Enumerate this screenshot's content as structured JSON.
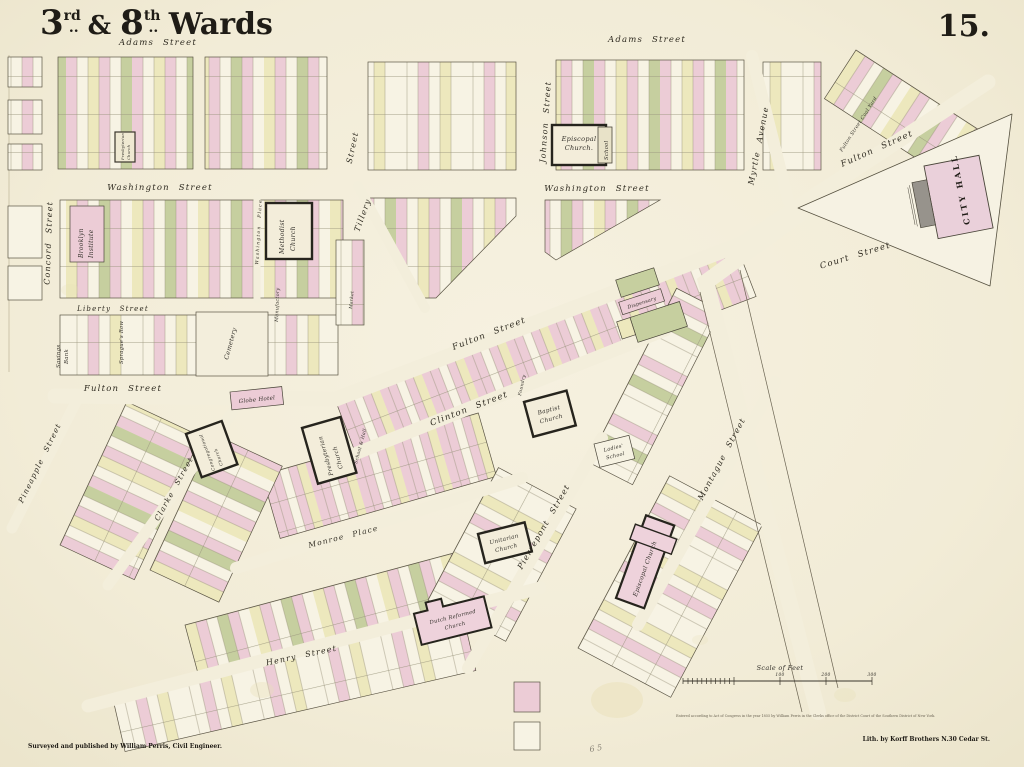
{
  "map": {
    "title": "3rd. & 8th. Wards",
    "title_parts": {
      "p1": "3",
      "p2": "rd",
      "p3": "..",
      "p4": " & ",
      "p5": "8",
      "p6": "th",
      "p7": "..",
      "p8": " Wards"
    },
    "plate_number": "15.",
    "pencil_note": "6 5"
  },
  "palette": {
    "paper": "#f3eedb",
    "block": "#f7f3e4",
    "pink": "#ecccd6",
    "yellow": "#ede8bd",
    "green": "#c6cf9f",
    "ink": "#3a362c",
    "church_fill": "#f3edda",
    "gray": "#97938c"
  },
  "streets": [
    {
      "name": "adams-street-west",
      "label": "Adams Street"
    },
    {
      "name": "adams-street-east",
      "label": "Adams Street"
    },
    {
      "name": "washington-street-west",
      "label": "Washington Street"
    },
    {
      "name": "washington-street-east",
      "label": "Washington Street"
    },
    {
      "name": "concord-street",
      "label": "Concord Street"
    },
    {
      "name": "johnson-street",
      "label": "Johnson Street"
    },
    {
      "name": "pearl-street-partial",
      "label": "Street"
    },
    {
      "name": "tillary-street",
      "label": "Tillery"
    },
    {
      "name": "washington-place",
      "label": "Washington Place"
    },
    {
      "name": "myrtle-avenue",
      "label": "Myrtle Avenue"
    },
    {
      "name": "fulton-street-northeast",
      "label": "Fulton Street"
    },
    {
      "name": "court-street",
      "label": "Court Street"
    },
    {
      "name": "liberty-street",
      "label": "Liberty Street"
    },
    {
      "name": "fulton-street-west",
      "label": "Fulton Street"
    },
    {
      "name": "fulton-street-center",
      "label": "Fulton Street"
    },
    {
      "name": "clinton-street",
      "label": "Clinton Street"
    },
    {
      "name": "pineapple-street",
      "label": "Pineapple Street"
    },
    {
      "name": "clarke-street",
      "label": "Clarke Street"
    },
    {
      "name": "monroe-place",
      "label": "Monroe Place"
    },
    {
      "name": "pierrepont-street",
      "label": "Pierrepont Street"
    },
    {
      "name": "montague-street",
      "label": "Montague Street"
    },
    {
      "name": "henry-street",
      "label": "Henry Street"
    }
  ],
  "landmarks": [
    {
      "name": "presbyterian-church-north",
      "line1": "Presbyterian",
      "line2": "Church"
    },
    {
      "name": "episcopal-church-north",
      "line1": "Episcopal",
      "line2": "Church."
    },
    {
      "name": "school-north",
      "label": "School"
    },
    {
      "name": "brooklyn-institute",
      "line1": "Brooklyn",
      "line2": "Institute"
    },
    {
      "name": "methodist-church",
      "line1": "Methodist",
      "line2": "Church"
    },
    {
      "name": "city-hall",
      "label": "CITY HALL"
    },
    {
      "name": "fulton-street-coal-yard",
      "label": "Fulton Street Coal Yard"
    },
    {
      "name": "savings-bank",
      "line1": "Savings",
      "line2": "Bank"
    },
    {
      "name": "spragues-row",
      "label": "Sprague's Row"
    },
    {
      "name": "cemetery",
      "label": "Cemetery"
    },
    {
      "name": "manufactory",
      "label": "Manufactory"
    },
    {
      "name": "market",
      "label": "Market"
    },
    {
      "name": "globe-hotel",
      "label": "Globe Hotel"
    },
    {
      "name": "presbyterian-church",
      "line1": "Presbyterian",
      "line2": "Church"
    },
    {
      "name": "school-hall",
      "label": "School & Hall"
    },
    {
      "name": "congregational-church",
      "line1": "Congregational",
      "line2": "Church"
    },
    {
      "name": "baptist-church",
      "line1": "Baptist",
      "line2": "Church"
    },
    {
      "name": "foundry",
      "label": "Foundry"
    },
    {
      "name": "ladies-school",
      "line1": "Ladies'",
      "line2": "School"
    },
    {
      "name": "dispensary",
      "label": "Dispensary"
    },
    {
      "name": "unitarian-church",
      "line1": "Unitarian",
      "line2": "Church"
    },
    {
      "name": "episcopal-church-south",
      "label": "Episcopal Church"
    },
    {
      "name": "dutch-reformed-church",
      "line1": "Dutch Reformed",
      "line2": "Church"
    }
  ],
  "scale": {
    "label": "Scale of Feet",
    "ticks": [
      "100",
      "200",
      "300"
    ]
  },
  "credits": {
    "surveyor": "Surveyed and published by William Perris, Civil Engineer.",
    "lithographer": "Lith. by Korff Brothers N.30 Cedar St.",
    "copyright": "Entered according to Act of Congress in the year 1855 by William Perris in the Clerks office of the District Court of the Southern District of New York."
  }
}
